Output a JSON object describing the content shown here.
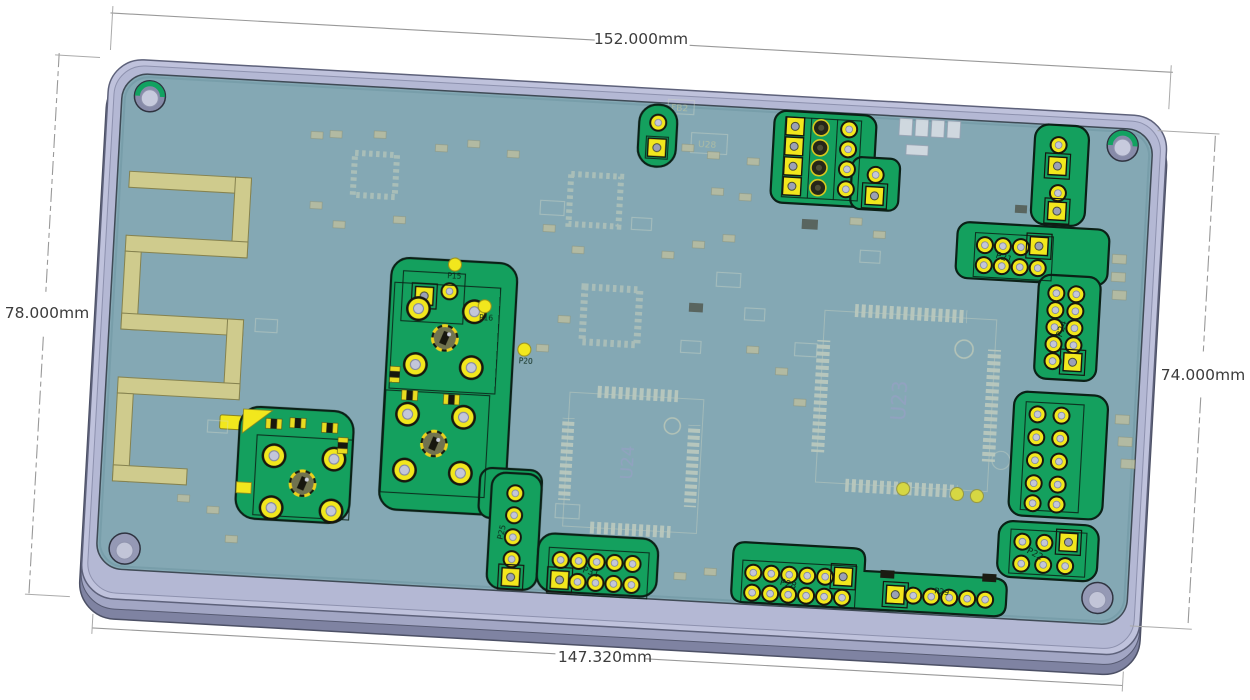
{
  "view": {
    "background": "#ffffff",
    "type": "cad-isometric-pcb-view"
  },
  "dimensions": {
    "top": "152.000mm",
    "bottom": "147.320mm",
    "left": "78.000mm",
    "right": "74.000mm"
  },
  "board": {
    "silkscreen_refs": {
      "u23": "U23",
      "u24": "U24",
      "u28": "U28",
      "fb2": "FB2"
    },
    "connector_refs": {
      "p15": "P15",
      "p16": "P16",
      "p20": "P20",
      "p21": "P21",
      "p22": "P22",
      "p24": "P24",
      "p25": "P25",
      "p28": "P28",
      "p29": "P29",
      "p31": "P31"
    },
    "colors": {
      "plate": "#bfc2dc",
      "plate_side": "#8b8fae",
      "pcb": "#84a8b4",
      "solder_mask": "#14a05e",
      "pad_yellow": "#f2e71d",
      "antenna": "#cfcb8d",
      "silkscreen": "#ccd3bf"
    }
  }
}
